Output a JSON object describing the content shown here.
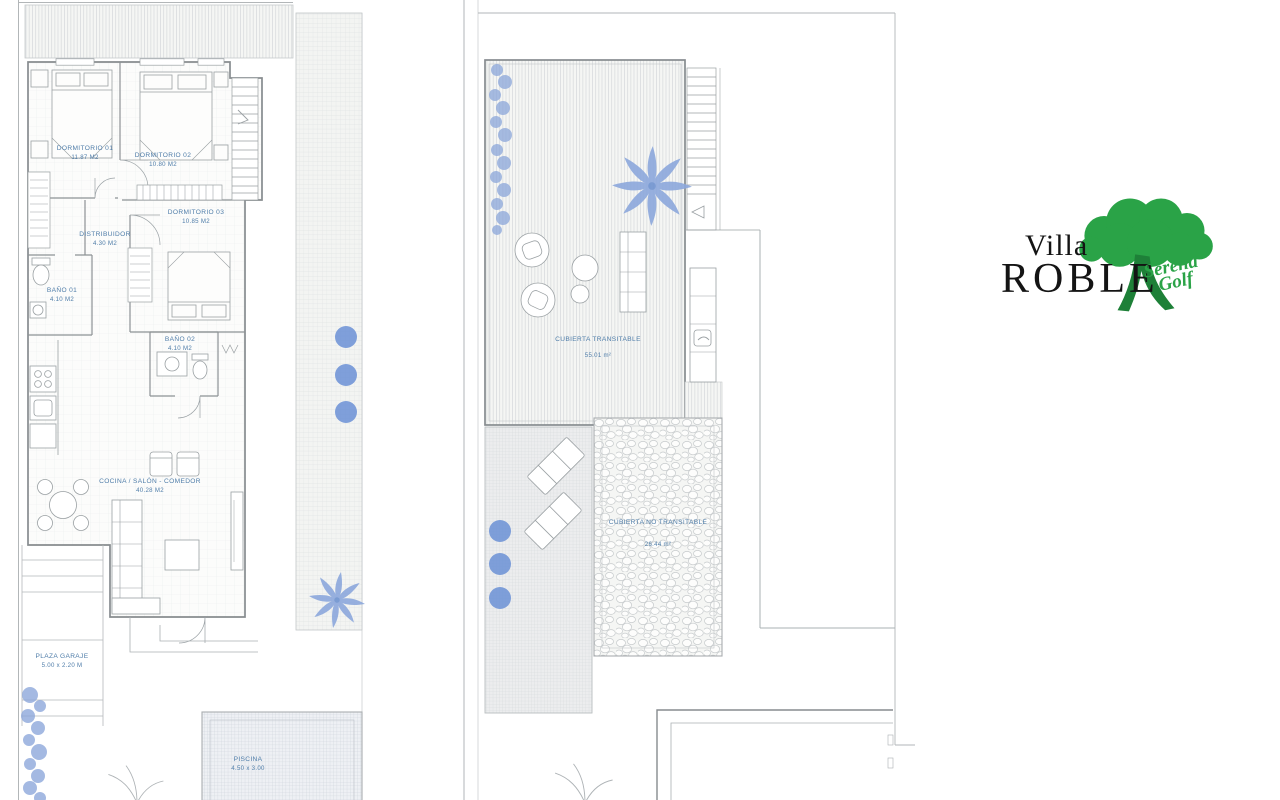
{
  "logo": {
    "villa": "Villa",
    "name": "ROBLE",
    "script1": "Serena",
    "script2": "Golf",
    "green": "#2aa347",
    "text_color": "#141414"
  },
  "colors": {
    "label_blue": "#4f7da9",
    "plant_blue": "#8ba6da",
    "bush_blue": "#6b91d6",
    "wall_gray": "#878c8f",
    "hatch_gray": "#d9dcde"
  },
  "ground_floor": {
    "rooms": [
      {
        "label": "DORMITORIO 01",
        "area": "11.87 M2"
      },
      {
        "label": "DORMITORIO 02",
        "area": "10.80 M2"
      },
      {
        "label": "DORMITORIO 03",
        "area": "10.85 M2"
      },
      {
        "label": "DISTRIBUIDOR",
        "area": "4.30 M2"
      },
      {
        "label": "BAÑO 01",
        "area": "4.10 M2"
      },
      {
        "label": "BAÑO 02",
        "area": "4.10 M2"
      },
      {
        "label": "COCINA / SALÓN - COMEDOR",
        "area": "40.28 M2"
      },
      {
        "label": "PLAZA GARAJE",
        "area": "5.00 x 2.20 M"
      },
      {
        "label": "PISCINA",
        "area": "4.50 x 3.00"
      }
    ]
  },
  "roof": {
    "rooms": [
      {
        "label": "CUBIERTA TRANSITABLE",
        "area": "55.01 m²"
      },
      {
        "label": "CUBIERTA NO TRANSITABLE",
        "area": "26.44 m²"
      }
    ]
  }
}
